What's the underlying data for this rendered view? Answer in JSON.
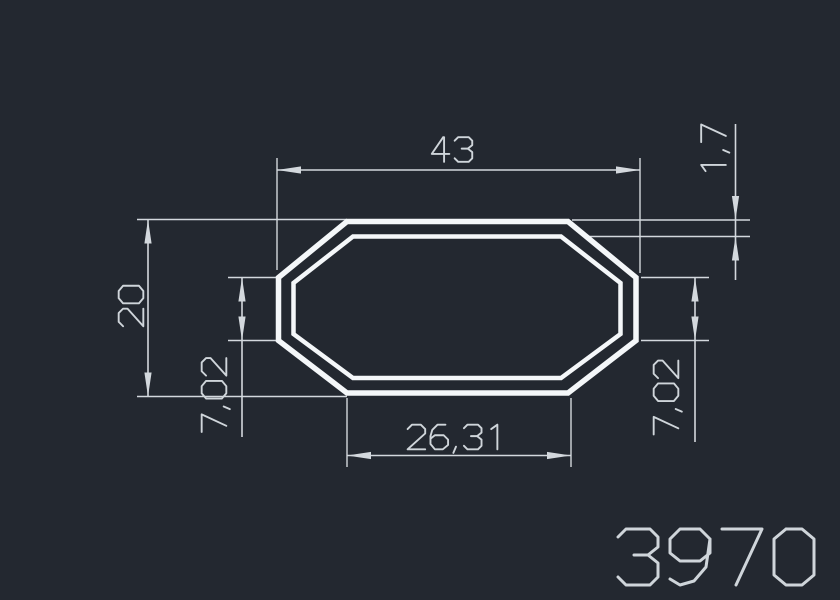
{
  "window": {
    "width": 840,
    "height": 600
  },
  "drawing": {
    "type": "extrusion-profile-cross-section",
    "shape": "octagonal tube, double contour (outer and inner wall)",
    "part_number": "3970",
    "dimensions": {
      "overall_width": "43",
      "overall_height": "20",
      "wall_thickness": "1,7",
      "left_side_height": "7,02",
      "right_side_height": "7,02",
      "bottom_width": "26,31"
    },
    "colors": {
      "background": "#232830",
      "dimension_lines": "#d3d8dd",
      "profile_outline": "#f4f7f9",
      "text": "#cfd5da"
    }
  }
}
